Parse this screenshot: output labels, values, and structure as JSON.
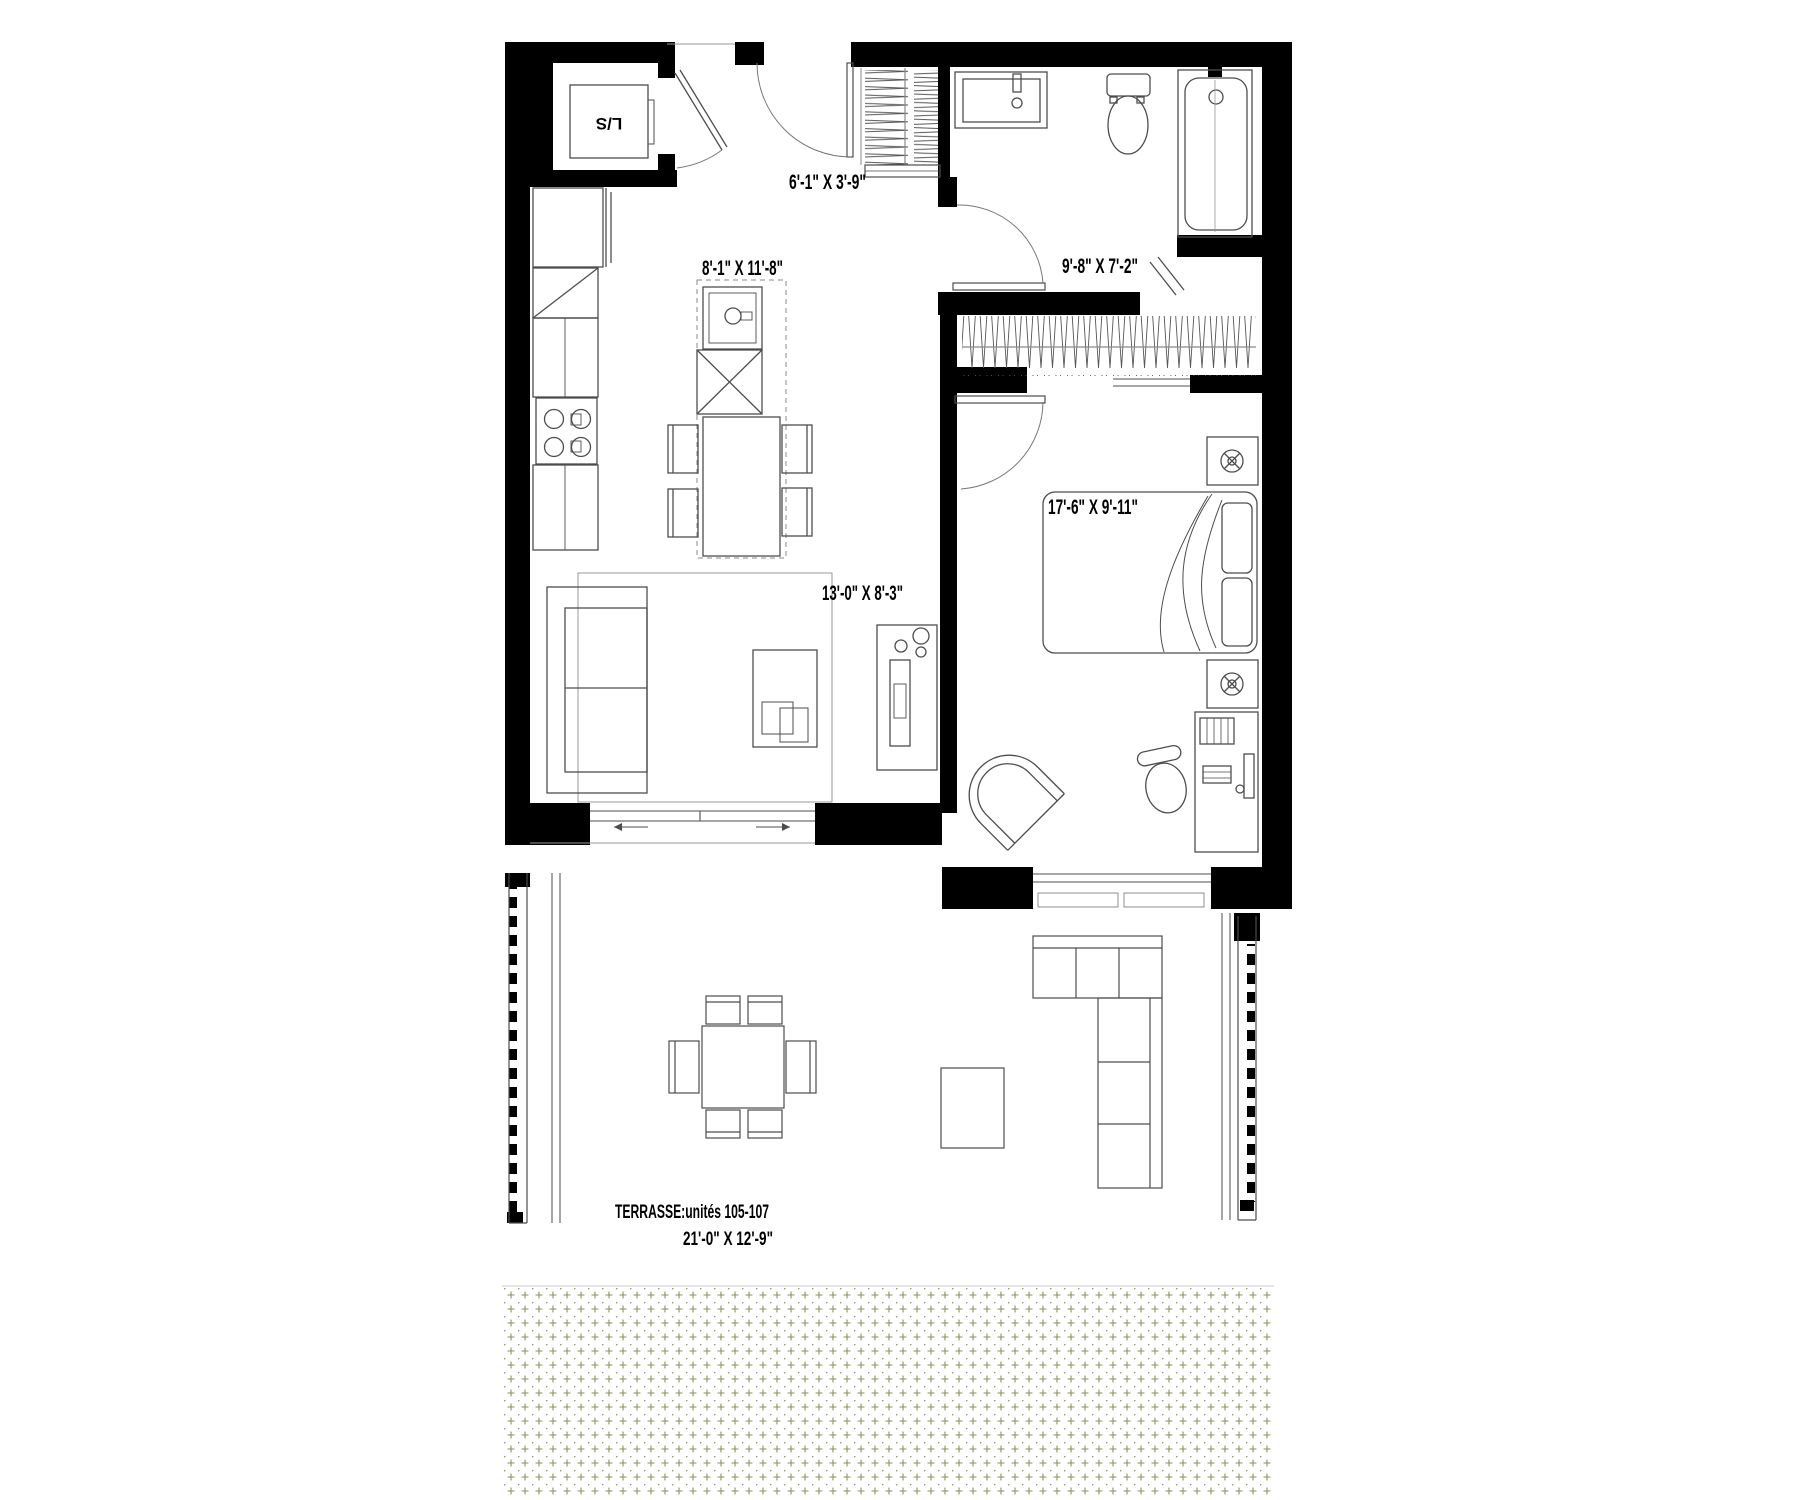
{
  "floorplan": {
    "background": "#ffffff",
    "wall_color": "#000000",
    "furniture_line_color": "#4d4d4d",
    "light_line_color": "#9a9a9a",
    "ground_pattern_color": "#8f8f60",
    "rooms": {
      "entry": {
        "name": "entry-hall",
        "dimensions": "6'-1\" X 3'-9\""
      },
      "kitchen_dining": {
        "name": "kitchen-dining",
        "dimensions": "8'-1\" X 11'-8\""
      },
      "bathroom": {
        "name": "bathroom",
        "dimensions": "9'-8\" X 7'-2\""
      },
      "bedroom": {
        "name": "bedroom",
        "dimensions": "17'-6\" X 9'-11\""
      },
      "living_room": {
        "name": "living-room",
        "dimensions": "13'-0\" X 8'-3\""
      }
    },
    "laundry_closet_label": "L/S",
    "terrace": {
      "label": "TERRASSE:unités 105-107",
      "dimensions": "21'-0\" X 12'-9\""
    },
    "fixtures": [
      "washer-dryer-closet",
      "entry-door",
      "coat-closet",
      "vanity-sink",
      "toilet",
      "bathtub",
      "walk-in-closet",
      "bedroom-door",
      "bed",
      "pillows",
      "nightstand-with-lamp",
      "desk",
      "office-chair",
      "accent-chair",
      "fridge",
      "corner-counter",
      "kitchen-counter",
      "cooktop",
      "island-sink",
      "dishwasher",
      "dining-table",
      "dining-chairs",
      "sofa",
      "area-rug",
      "coffee-table",
      "media-console",
      "sliding-patio-door",
      "bedroom-window",
      "terrace-railing",
      "terrace-dining-table",
      "terrace-chairs",
      "terrace-sectional",
      "terrace-side-table",
      "ground-planting-strip"
    ]
  }
}
